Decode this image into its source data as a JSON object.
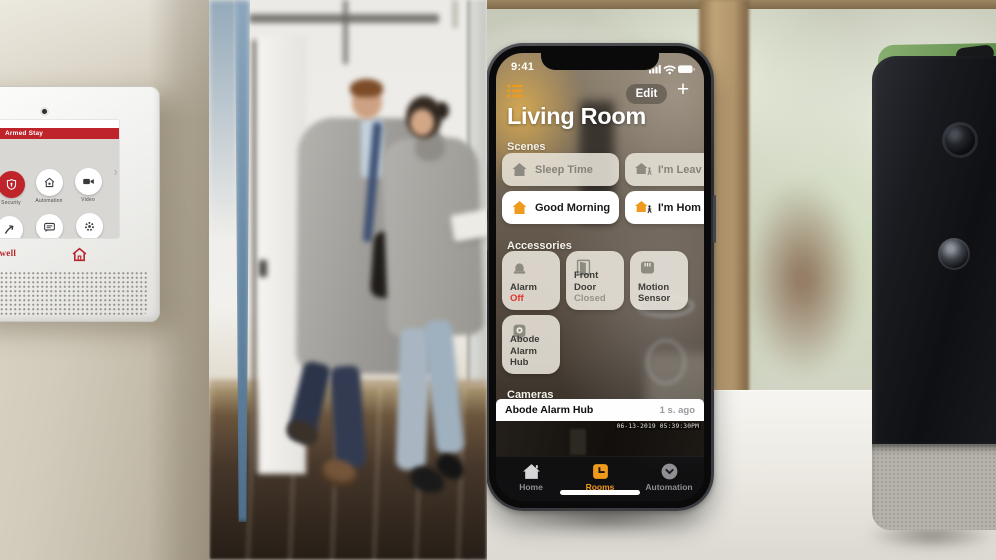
{
  "security_panel": {
    "brand": "Honeywell",
    "status": "Armed Stay",
    "panel_red": "#bf242b",
    "apps": [
      {
        "label": "Security",
        "icon": "shield-lock-icon"
      },
      {
        "label": "Automation",
        "icon": "home-icon"
      },
      {
        "label": "Video",
        "icon": "video-camera-icon"
      },
      {
        "label": "Smart Scenes",
        "icon": "arrow-icon"
      },
      {
        "label": "Notices",
        "icon": "message-icon"
      },
      {
        "label": "Settings",
        "icon": "gear-icon"
      }
    ]
  },
  "home_app": {
    "time": "9:41",
    "edit_label": "Edit",
    "add_label": "+",
    "title": "Living Room",
    "accent_color": "#f09a1d",
    "alert_color": "#e0352b",
    "scenes": {
      "label": "Scenes",
      "items": [
        {
          "name": "Sleep Time",
          "state": "inactive"
        },
        {
          "name": "I'm Leav",
          "state": "inactive"
        },
        {
          "name": "Good Morning",
          "state": "active"
        },
        {
          "name": "I'm Hom",
          "state": "active"
        }
      ]
    },
    "accessories": {
      "label": "Accessories",
      "items": [
        {
          "name": "Alarm",
          "status": "Off"
        },
        {
          "name": "Front Door",
          "status": "Closed"
        },
        {
          "name": "Motion Sensor",
          "status": ""
        },
        {
          "name": "Abode Alarm Hub",
          "status": ""
        }
      ]
    },
    "cameras": {
      "label": "Cameras",
      "name": "Abode Alarm Hub",
      "last_update": "1 s. ago",
      "timestamp": "06-13-2019 05:39:30PM"
    },
    "tabs": [
      {
        "label": "Home"
      },
      {
        "label": "Rooms"
      },
      {
        "label": "Automation"
      }
    ]
  }
}
